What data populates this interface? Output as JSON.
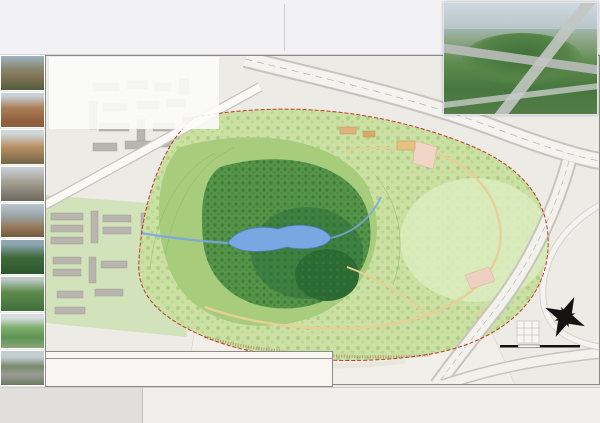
{
  "header": {
    "title_cn": "深圳市安托山公园总体规划",
    "title_en": "The Overall Planning and Design of Mt.Antuo Park, Shenzhen",
    "desc_heading": "规划说明:",
    "desc_paragraphs": [
      "安托山公园位于深圳市福田区西北部，北临北环大道，东接侨城东路，南邻深康村，规划总用地面积约52.4万平方米。场地原为采石场，山体开采破损严重，植被缺失，水土流失明显，生态修复与山体复绿是本次规划面临的首要问题。",
      "规划在保护现状山体和植被的前提下，结合场地竖向条件布置入口广场、环山游览道、观景平台、湖区及配套服务设施，完善公园游览体系，将安托山公园建设成为集生态恢复、休闲游憩、科普教育于一体的综合性城市山地公园。"
    ]
  },
  "concept": {
    "heading": "规划设计理念:",
    "lead": "本规划以",
    "keyword": "“印记·重生”",
    "body": "为总体设计理念。尊重场地采石工业遗迹，保留山体开采的时代印记，通过生态修复手段使破损山体重获新生；以环山绿道串联各景观节点，因地制宜布置观景平台与游憩设施，营造自然野趣与人文记忆交融的山地公园，体现人与自然和谐共生的“共生”主题。"
  },
  "map": {
    "villages": [
      {
        "label": "深 云 村",
        "x": 105,
        "y": 49
      },
      {
        "label": "深 康 村",
        "x": 310,
        "y": 307
      }
    ],
    "road_chars": [
      {
        "ch": "北",
        "x": 338,
        "y": 8
      },
      {
        "ch": "环",
        "x": 388,
        "y": 26
      },
      {
        "ch": "大",
        "x": 502,
        "y": 53
      },
      {
        "ch": "道",
        "x": 512,
        "y": 72
      },
      {
        "ch": "侨",
        "x": 520,
        "y": 193
      },
      {
        "ch": "城",
        "x": 483,
        "y": 255
      },
      {
        "ch": "东",
        "x": 455,
        "y": 285
      },
      {
        "ch": "路",
        "x": 415,
        "y": 320
      },
      {
        "ch": "建",
        "x": 83,
        "y": 113
      },
      {
        "ch": "协",
        "x": 107,
        "y": 105
      },
      {
        "ch": "路",
        "x": 130,
        "y": 97
      }
    ],
    "road_names": [
      {
        "label": "安 兴 路",
        "x": 508,
        "y": 312
      }
    ],
    "entrances": [
      {
        "label": "次入口",
        "x": 363,
        "y": 52
      },
      {
        "label": "主入口",
        "x": 475,
        "y": 263
      }
    ],
    "features": [
      {
        "label": "叠水溪谷",
        "x": 343,
        "y": 98
      },
      {
        "label": "跃动风籁",
        "x": 436,
        "y": 103
      },
      {
        "label": "访古寻幽",
        "x": 177,
        "y": 197
      },
      {
        "label": "登高揽翠",
        "x": 341,
        "y": 200
      },
      {
        "label": "鹏城印记",
        "x": 435,
        "y": 238
      }
    ],
    "roadside_labels": [
      {
        "label": "公交停靠站",
        "x": 345,
        "y": 35
      },
      {
        "label": "人行天桥",
        "x": 420,
        "y": 47
      },
      {
        "label": "北环立交匝道",
        "x": 528,
        "y": 98
      },
      {
        "label": "辅道出入口",
        "x": 534,
        "y": 140
      },
      {
        "label": "公交站台",
        "x": 518,
        "y": 212
      }
    ],
    "markers": [
      {
        "n": "1",
        "x": 458,
        "y": 250
      },
      {
        "n": "2",
        "x": 447,
        "y": 225
      },
      {
        "n": "3",
        "x": 430,
        "y": 262
      },
      {
        "n": "4",
        "x": 418,
        "y": 190,
        "cls": "yellow"
      },
      {
        "n": "5",
        "x": 387,
        "y": 188
      },
      {
        "n": "6",
        "x": 365,
        "y": 240
      },
      {
        "n": "7",
        "x": 398,
        "y": 253
      },
      {
        "n": "8",
        "x": 412,
        "y": 275
      },
      {
        "n": "9",
        "x": 470,
        "y": 240
      },
      {
        "n": "10",
        "x": 273,
        "y": 251
      },
      {
        "n": "11",
        "x": 338,
        "y": 233
      },
      {
        "n": "12",
        "x": 357,
        "y": 223
      },
      {
        "n": "13",
        "x": 338,
        "y": 183
      },
      {
        "n": "14",
        "x": 290,
        "y": 242
      },
      {
        "n": "15",
        "x": 180,
        "y": 225
      },
      {
        "n": "16",
        "x": 315,
        "y": 253
      },
      {
        "n": "17",
        "x": 163,
        "y": 183
      },
      {
        "n": "18",
        "x": 245,
        "y": 183
      },
      {
        "n": "19",
        "x": 207,
        "y": 192
      },
      {
        "n": "20",
        "x": 123,
        "y": 187
      },
      {
        "n": "21",
        "x": 238,
        "y": 82
      },
      {
        "n": "22",
        "x": 258,
        "y": 145
      },
      {
        "n": "23",
        "x": 295,
        "y": 103
      },
      {
        "n": "24",
        "x": 393,
        "y": 72
      },
      {
        "n": "25",
        "x": 382,
        "y": 100
      },
      {
        "n": "26",
        "x": 410,
        "y": 77
      },
      {
        "n": "27",
        "x": 468,
        "y": 108
      },
      {
        "n": "28",
        "x": 412,
        "y": 102
      },
      {
        "n": "29",
        "x": 375,
        "y": 110
      },
      {
        "n": "30",
        "x": 385,
        "y": 122
      },
      {
        "n": "31",
        "x": 445,
        "y": 168
      },
      {
        "n": "32",
        "x": 485,
        "y": 154
      },
      {
        "n": "33",
        "x": 430,
        "y": 117
      },
      {
        "n": "34",
        "x": 408,
        "y": 132
      }
    ],
    "compass_n": "N",
    "scale_label": "0   20   50            100米"
  },
  "table": {
    "caption": "安托山公园规划主要经济技术指标表",
    "rows": [
      {
        "l": "红线范围总用地: ㎡",
        "v": "524,000",
        "l2": "建筑总面积: ㎡",
        "v2": "3916"
      },
      {
        "l": "容积率",
        "v": "0.01",
        "l2": "园路及铺装场地: ㎡",
        "v2": "3,623"
      },
      {
        "l": "建筑密度(覆盖率): %",
        "v": "0.57",
        "l2": "水体面积: ㎡",
        "v2": "22098"
      },
      {
        "l": "绿化面积: ㎡",
        "v": "501204",
        "l2": "停车场面积: ㎡",
        "v2": "4619"
      },
      {
        "l": "绿化率: %",
        "v": "67.9",
        "l2": "广场面积: ㎡",
        "v2": "6048"
      }
    ]
  },
  "legend": {
    "label": "图例:",
    "columns": [
      [
        "1. 游客中心",
        "2. 城市之光",
        "3. 停车场",
        "4. 直通梯道"
      ],
      [
        "5. 红韵溪谷",
        "6. 望山叠瀑",
        "7. 管理处、配套用房",
        "8. 花海畅想"
      ],
      [
        "9. 老年广场",
        "10. 游园西",
        "11. 观景台",
        "12. 山顶观景广场"
      ],
      [
        "13. 疏影斋",
        "14. 大草坪",
        "15. 览胜亭",
        "16. 山口亭"
      ],
      [
        "17. 依松涧谷",
        "18. 竹风茶舍",
        "19. 湖畔亭",
        "20. 烟雨轻渡"
      ],
      [
        "21. 待月亭",
        "22. 茶翠亭",
        "23. 曲径通幽",
        "24. 主环道入口"
      ],
      [
        "25. 次入口广场",
        "26. 小型停车场",
        "27. 儿童活动区域",
        "28. 瞭望塔"
      ],
      [
        "29. 叠水景观",
        "30. 心愿景观",
        "31. 人行天桥",
        "32. 观光塔"
      ],
      [
        "33. 自行车道",
        "34. 景墙雕塑群"
      ]
    ]
  },
  "titleblock": {
    "lines": [
      "深圳市北林苑景观及建筑规划设计院有限公司",
      "Shenzhen BLY Landscape & Architecture Planning Institute",
      "工程名称: 深圳市安托山公园总体规划",
      "图名: 总体规划平面图    比例 1:2000"
    ]
  }
}
